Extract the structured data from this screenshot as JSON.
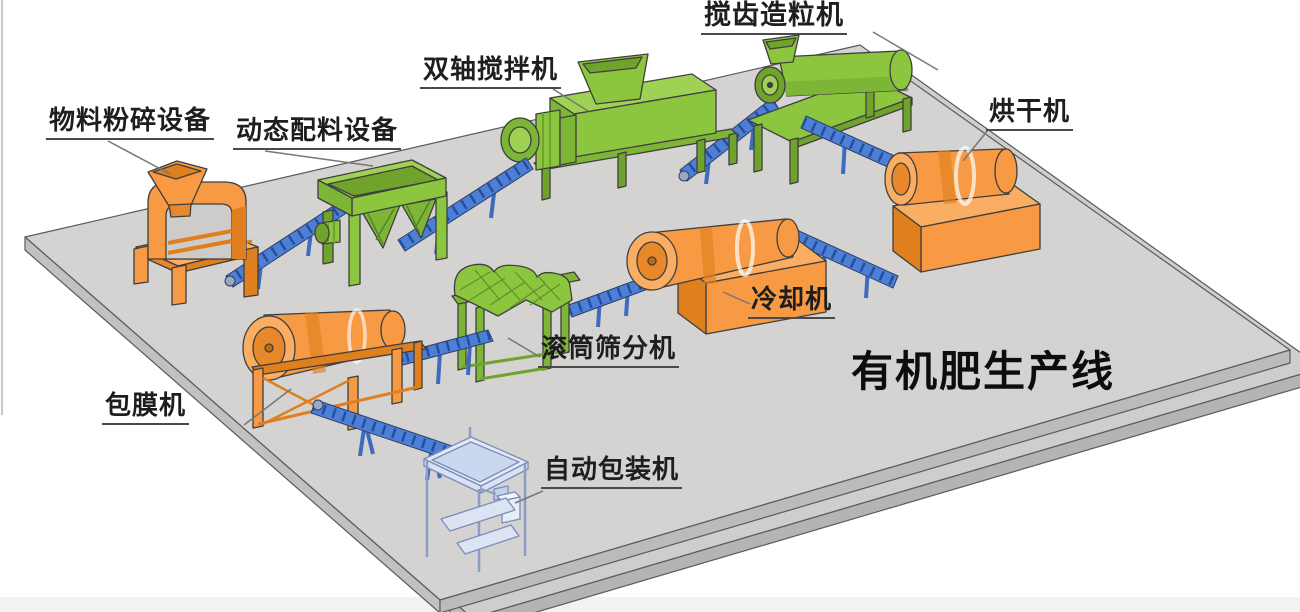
{
  "title": "有机肥生产线",
  "equipment": [
    {
      "id": "crusher",
      "label": "物料粉碎设备",
      "color": "orange"
    },
    {
      "id": "batching",
      "label": "动态配料设备",
      "color": "green"
    },
    {
      "id": "mixer",
      "label": "双轴搅拌机",
      "color": "green"
    },
    {
      "id": "granulator",
      "label": "搅齿造粒机",
      "color": "green"
    },
    {
      "id": "dryer",
      "label": "烘干机",
      "color": "orange"
    },
    {
      "id": "cooler",
      "label": "冷却机",
      "color": "orange"
    },
    {
      "id": "screener",
      "label": "滚筒筛分机",
      "color": "green"
    },
    {
      "id": "coater",
      "label": "包膜机",
      "color": "orange"
    },
    {
      "id": "packer",
      "label": "自动包装机",
      "color": "light-blue"
    }
  ],
  "colors": {
    "machine_green": "#8CC63F",
    "machine_orange": "#F79A43",
    "conveyor_blue": "#4E7FD6",
    "packer_pale_blue": "#DCE4F4",
    "platform_gray": "#D4D3D1",
    "label_text": "#1e1e1e"
  }
}
